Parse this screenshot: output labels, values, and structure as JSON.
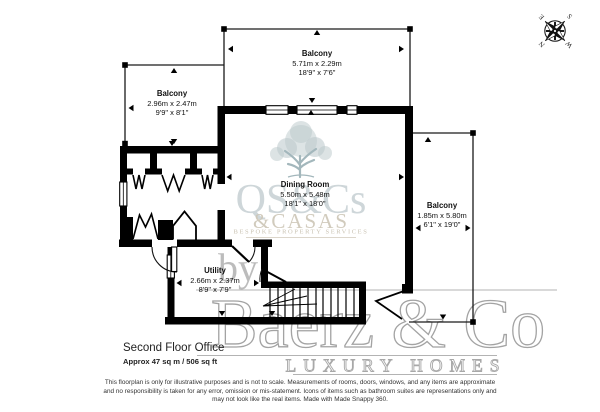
{
  "floorplan": {
    "title": "Second Floor Office",
    "area": "Approx 47 sq m / 506 sq ft",
    "rooms": [
      {
        "name": "Balcony",
        "metric": "5.71m x 2.29m",
        "imperial": "18'9\" x 7'6\""
      },
      {
        "name": "Balcony",
        "metric": "2.96m x 2.47m",
        "imperial": "9'9\" x 8'1\""
      },
      {
        "name": "Dining Room",
        "metric": "5.50m x 5.48m",
        "imperial": "18'1\" x 18'0\""
      },
      {
        "name": "Balcony",
        "metric": "1.85m x 5.80m",
        "imperial": "6'1\" x 19'0\""
      },
      {
        "name": "Utility",
        "metric": "2.66m x 2.37m",
        "imperial": "8'9\" x 7'9\""
      }
    ],
    "compass": {
      "n": "N",
      "e": "E",
      "s": "S",
      "w": "W"
    },
    "watermark": {
      "logo_monogram": "QS&Cs",
      "logo_name": "&CASAS",
      "logo_tagline": "BESPOKE PROPERTY SERVICES",
      "by": "by",
      "brand": "Baerz & Co",
      "brand_tagline": "LUXURY HOMES"
    },
    "disclaimer": [
      "This floorplan is only for illustrative purposes and is not to scale. Measurements of rooms, doors, windows, and any items are approximate",
      "and no responsibility is taken for any error, omission or mis-statement. Icons of items such as bathroom suites are representations only and",
      "may not look like the real items. Made with Made Snappy 360."
    ],
    "colors": {
      "wall": "#000000",
      "watermark_blue": "#bdc9cc",
      "watermark_beige": "#cbc4b4",
      "watermark_gray": "#9d9d9d"
    }
  }
}
